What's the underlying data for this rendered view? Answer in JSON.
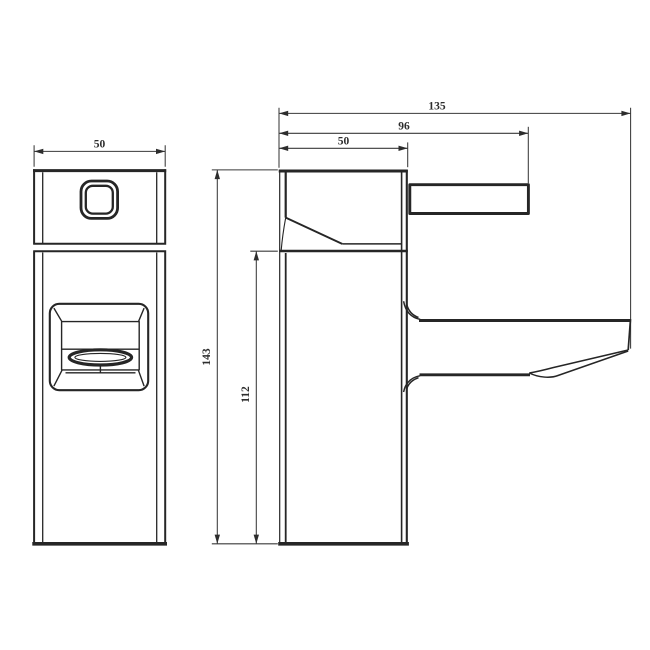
{
  "diagram": {
    "type": "technical-drawing",
    "subject": "basin tap - front and side elevation with dimensions",
    "background": "#ffffff",
    "line_color": "#262626",
    "dimension_line_color": "#3a3a3a",
    "text_color": "#2d2d2d",
    "dimensions": {
      "front_width": "50",
      "overall_length": "135",
      "handle_reach": "96",
      "body_depth": "50",
      "overall_height": "143",
      "body_height": "112"
    }
  }
}
